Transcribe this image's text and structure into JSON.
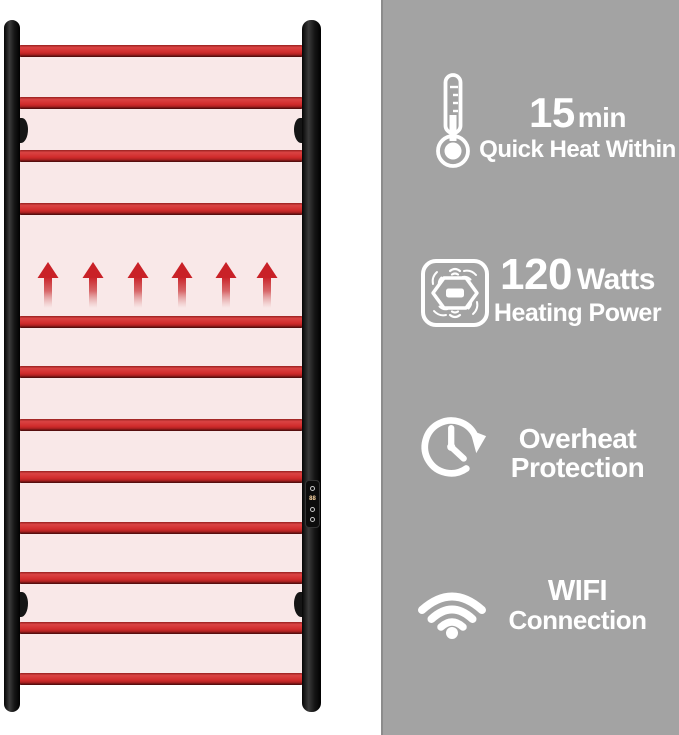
{
  "product": {
    "control_panel": {
      "display_value": "88"
    }
  },
  "features": [
    {
      "icon": "thermometer-icon",
      "value": "15",
      "unit": "min",
      "label": "Quick Heat Within"
    },
    {
      "icon": "heating-element-icon",
      "value": "120",
      "unit": "Watts",
      "label": "Heating Power"
    },
    {
      "icon": "overheat-clock-icon",
      "line1": "Overheat",
      "line2": "Protection"
    },
    {
      "icon": "wifi-icon",
      "line1": "WIFI",
      "line2": "Connection"
    }
  ],
  "colors": {
    "feature_panel_gray": "#a3a3a3",
    "panel_edge_gray": "#8c8c8c",
    "bar_red": "#d02c2c",
    "towel_panel_pink": "#f9e8e8",
    "rail_black": "#161616",
    "arrow_red": "#c92127",
    "text_white": "#ffffff"
  }
}
